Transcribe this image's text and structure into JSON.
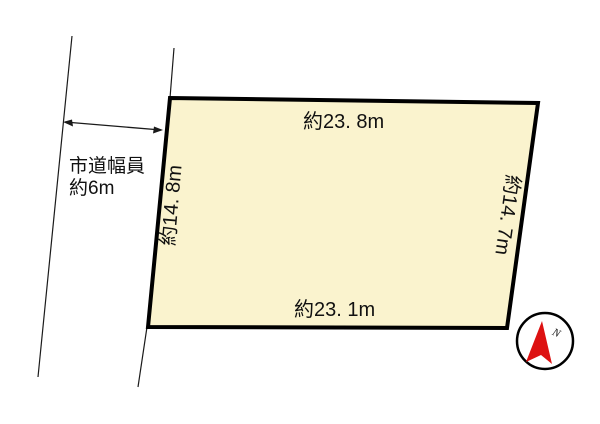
{
  "page": {
    "background": "#ffffff"
  },
  "parcel": {
    "fill": "#faf3ce",
    "outline_color": "#000000",
    "dim_top": "約23. 8m",
    "dim_bottom": "約23. 1m",
    "dim_left": "約14. 8m",
    "dim_right": "約14. 7m"
  },
  "road": {
    "width_label_line1": "市道幅員",
    "width_label_line2": "約6m"
  },
  "compass": {
    "north_label": "N",
    "needle_color": "#dd1111",
    "ring_color": "#000000"
  }
}
